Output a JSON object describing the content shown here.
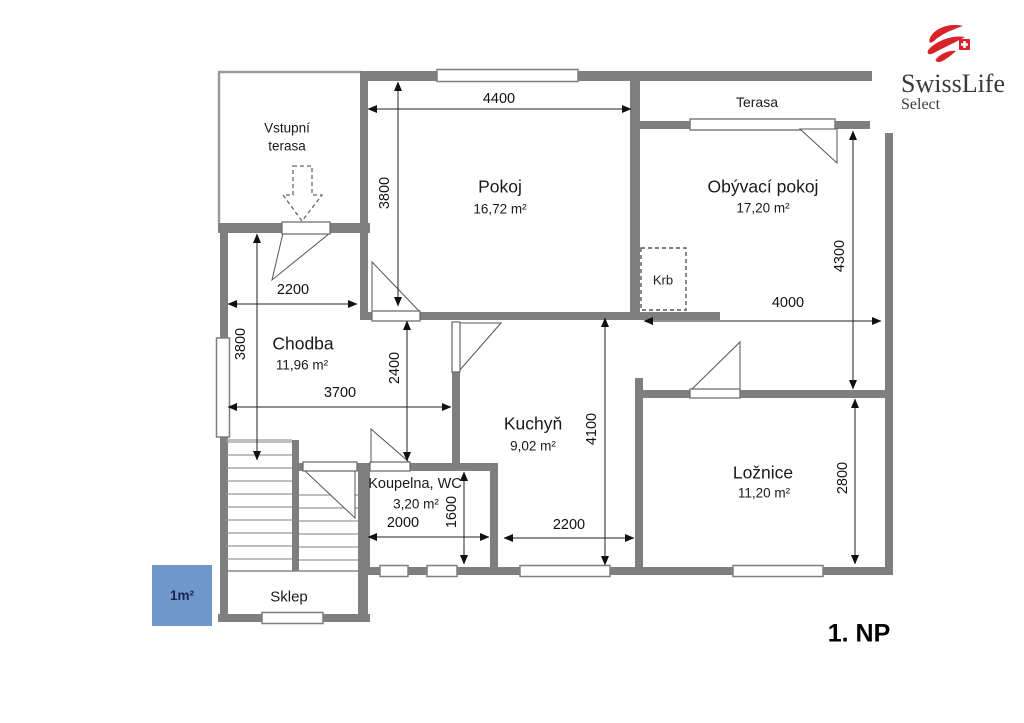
{
  "meta": {
    "floor_label": "1. NP"
  },
  "logo": {
    "brand": "SwissLife",
    "sub": "Select"
  },
  "legend": {
    "scale_label": "1m²"
  },
  "rooms": {
    "pokoj": {
      "name": "Pokoj",
      "area": "16,72 m²"
    },
    "obyvaci": {
      "name": "Obývací pokoj",
      "area": "17,20 m²"
    },
    "chodba": {
      "name": "Chodba",
      "area": "11,96 m²"
    },
    "kuchyn": {
      "name": "Kuchyň",
      "area": "9,02 m²"
    },
    "loznice": {
      "name": "Ložnice",
      "area": "11,20 m²"
    },
    "koupelna": {
      "name": "Koupelna, WC",
      "area": "3,20 m²"
    },
    "sklep": {
      "name": "Sklep"
    },
    "terasa": {
      "name": "Terasa"
    },
    "vstupni_terasa": {
      "line1": "Vstupní",
      "line2": "terasa"
    },
    "krb": {
      "name": "Krb"
    }
  },
  "dimensions": {
    "pokoj_width": "4400",
    "pokoj_height": "3800",
    "chodba_top_width": "2200",
    "chodba_height": "3800",
    "chodba_width": "3700",
    "hall_kitchen_height": "2400",
    "kuchyn_height": "4100",
    "kuchyn_width": "2200",
    "koupelna_width": "2000",
    "koupelna_height": "1600",
    "obyvaci_height": "4300",
    "obyvaci_width": "4000",
    "loznice_height": "2800"
  },
  "colors": {
    "wall": "#7f7f7f",
    "legend_blue": "#6f97cb",
    "logo_red": "#d9232a",
    "dim_line": "#333333"
  }
}
